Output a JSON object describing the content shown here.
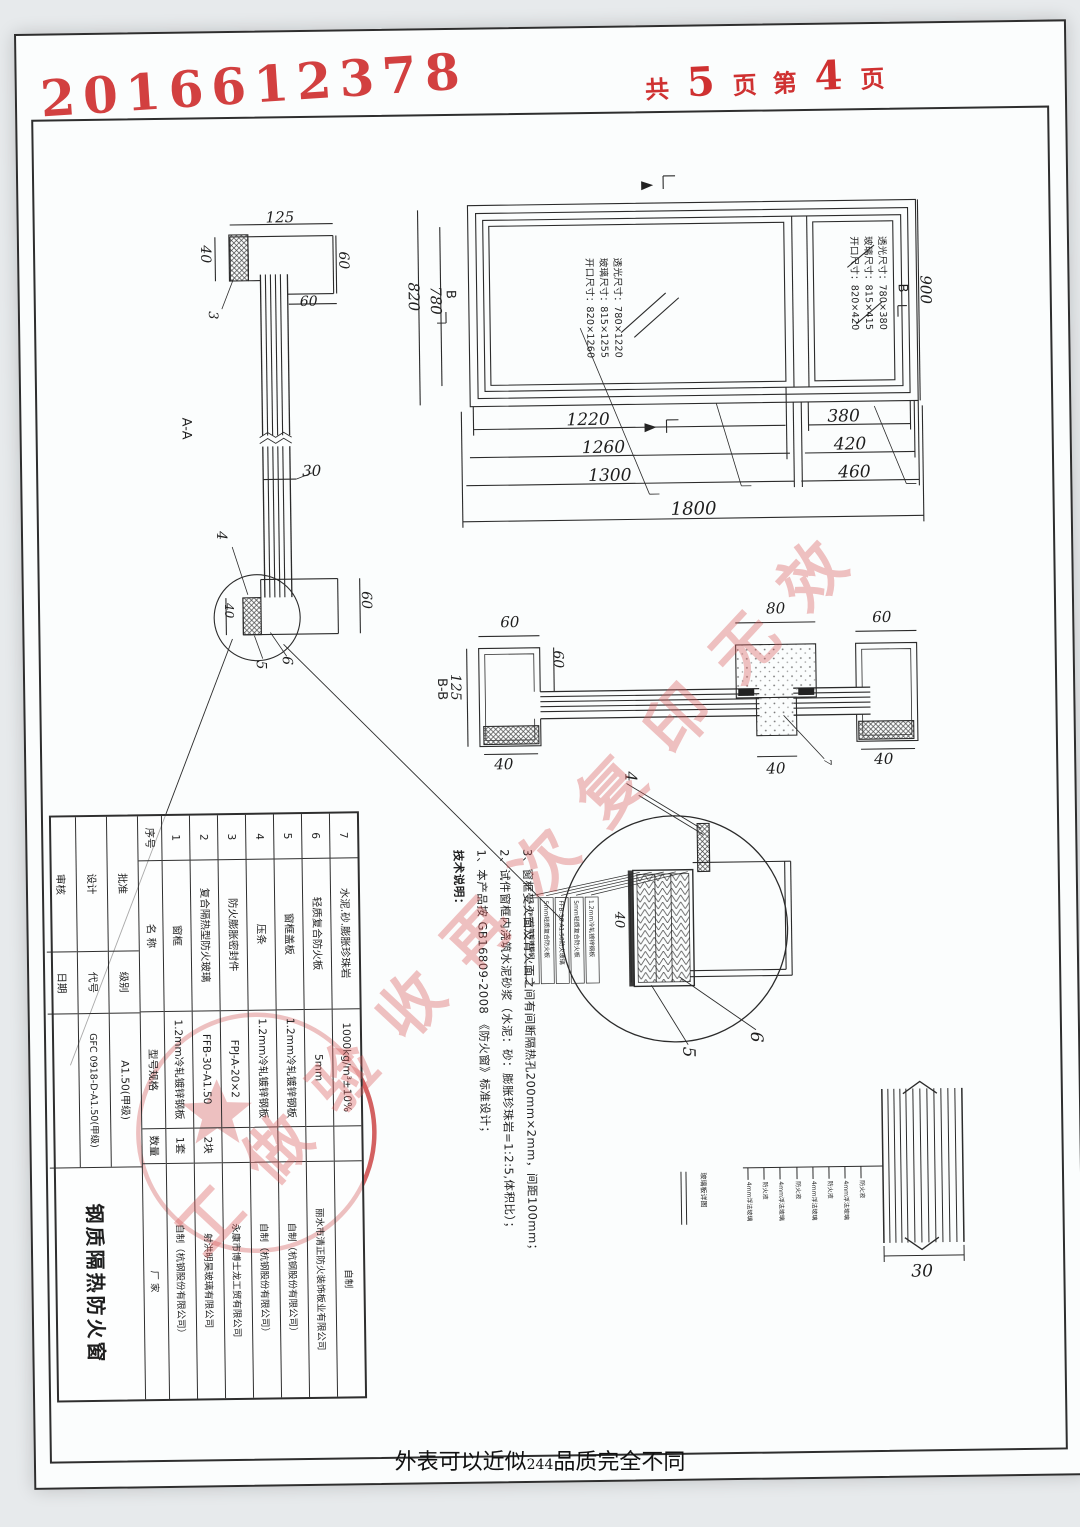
{
  "stamp": {
    "serial": "2016612378"
  },
  "pagination": {
    "total_label": "共",
    "total": "5",
    "unit_label": "页",
    "ordinal_label": "第",
    "current": "4",
    "unit_label2": "页"
  },
  "watermark": {
    "text": "工做验收再次复印无效"
  },
  "caption": {
    "prefix": "外表可以近似",
    "number": "244",
    "suffix": "品质完全不同"
  },
  "elevation": {
    "left_pane_labels": [
      "开口尺寸：820×1260",
      "玻璃尺寸：815×1255",
      "透光尺寸：780×1220"
    ],
    "right_pane_labels": [
      "开口尺寸：820×420",
      "玻璃尺寸：815×415",
      "透光尺寸：780×380"
    ],
    "marker_a": "A",
    "marker_b_left": "B",
    "marker_b_right": "B",
    "dims": {
      "left_inner": "780",
      "left_outer": "820",
      "right": "900",
      "row1_left": "1220",
      "row1_right": "380",
      "row2_left": "1260",
      "row2_right": "420",
      "row3_left": "1300",
      "row3_right": "460",
      "total": "1800"
    }
  },
  "section_aa": {
    "label": "A-A",
    "dims": {
      "top_width": "125",
      "top_40": "40",
      "top_60_right": "60",
      "top_60_below": "60",
      "glass_30": "30",
      "bottom_40": "40",
      "bottom_60": "60"
    },
    "leaders": {
      "l3": "3",
      "l4": "4",
      "l5": "5",
      "l6": "6"
    }
  },
  "section_bb": {
    "label": "B-B",
    "dims": {
      "left_60": "60",
      "inner_60": "60",
      "left_125": "125",
      "left_40": "40",
      "center_80": "80",
      "center_40": "40",
      "right_60": "60",
      "right_40": "40"
    },
    "leaders": {
      "l7": "7",
      "l4": "4"
    }
  },
  "detail_circle": {
    "dim_40": "40",
    "leaders": {
      "l4": "4",
      "l5": "5",
      "l6": "6"
    },
    "callouts": [
      "1.2mm冷轧镀锌钢板",
      "5mm轻质复合防火板",
      "FFB-30-A1.50防火玻璃",
      "5mm轻质复合防火板",
      "1.2mm冷轧镀锌钢板"
    ]
  },
  "glass_detail": {
    "title": "玻璃板详图",
    "total_30": "30",
    "layers": [
      "4mm浮法玻璃",
      "防火液",
      "4mm浮法玻璃",
      "防火液",
      "4mm浮法玻璃",
      "防火液",
      "4mm浮法玻璃",
      "防火液"
    ]
  },
  "notes": {
    "title": "技术说明：",
    "items": [
      "1、本产品按 GB16809-2008 《防火窗》标准设计；",
      "2、试件窗框内浇筑水泥砂浆（水泥：砂：膨胀珍珠岩=1:2:5,体积比）；",
      "3、窗框受火面及背火面之间有间断隔热孔200mm×2mm，间距100mm；"
    ]
  },
  "table": {
    "headers": [
      "序号",
      "名  称",
      "型号规格",
      "数量",
      "厂  家"
    ],
    "rows": [
      {
        "no": "7",
        "name": "水泥.砂.膨胀珍珠岩",
        "spec": "1000kg/m³±10%",
        "qty": "",
        "maker": "自制"
      },
      {
        "no": "6",
        "name": "轻质复合防火板",
        "spec": "5mm",
        "qty": "",
        "maker": "丽水市清正防火装饰板业有限公司"
      },
      {
        "no": "5",
        "name": "窗框盖板",
        "spec": "1.2mm冷轧镀锌钢板",
        "qty": "",
        "maker": "自制（杭钢股份有限公司）"
      },
      {
        "no": "4",
        "name": "压条",
        "spec": "1.2mm冷轧镀锌钢板",
        "qty": "",
        "maker": "自制（杭钢股份有限公司）"
      },
      {
        "no": "3",
        "name": "防火膨胀密封件",
        "spec": "FPJ-A-20×2",
        "qty": "",
        "maker": "永康市博士龙工贸有限公司"
      },
      {
        "no": "2",
        "name": "复合隔热型防火玻璃",
        "spec": "FFB-30-A1.50",
        "qty": "2块",
        "maker": "射洪明昊玻璃有限公司"
      },
      {
        "no": "1",
        "name": "窗框",
        "spec": "1.2mm冷轧镀锌钢板",
        "qty": "1套",
        "maker": "自制（杭钢股份有限公司）"
      }
    ],
    "title_block": {
      "product": "钢质隔热防火窗",
      "rows": [
        {
          "left": "批准",
          "mid": "级别",
          "value": "A1.50(甲级)"
        },
        {
          "left": "设计",
          "mid": "代号",
          "value": "GFC 0918-D-A1.50(甲级)"
        },
        {
          "left": "审核",
          "mid": "日期",
          "value": ""
        }
      ]
    }
  }
}
